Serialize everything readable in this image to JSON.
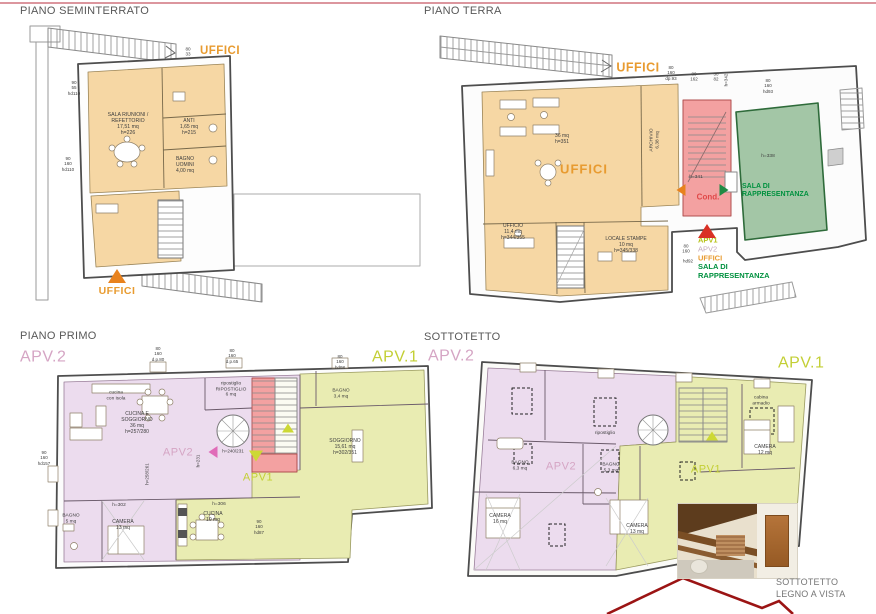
{
  "page": {
    "top_rule_color": "#dc969e"
  },
  "plans": {
    "seminterrato": {
      "title": "PIANO SEMINTERRATO"
    },
    "terra": {
      "title": "PIANO TERRA"
    },
    "primo": {
      "title": "PIANO PRIMO"
    },
    "sottotetto": {
      "title": "SOTTOTETTO"
    }
  },
  "photo": {
    "caption": "SOTTOTETTO\nLEGNO A VISTA"
  },
  "colors": {
    "uffici_orange": "#e89b30",
    "apv1_green": "#c3cf35",
    "apv2_pink": "#d5a5c4",
    "sala_green": "#00913f",
    "cond_red": "#e04848",
    "fill_orange": "#f6d7a4",
    "fill_pink": "#ecdcee",
    "fill_yellow": "#e9ecb2",
    "fill_green": "#a3c6a6",
    "fill_stair_red": "#f3a1a1"
  },
  "labels": [
    {
      "name": "label-uffici-top-seminterrato",
      "text": "UFFICI",
      "x": 220,
      "y": 52,
      "size": 11.5,
      "color": "#e89b30",
      "bold": 1,
      "ls": 0.5
    },
    {
      "name": "label-sala-riunioni",
      "text": "SALA RIUNIONI /\nREFETTORIO\n17,51 mq\nh=226",
      "x": 128,
      "y": 124,
      "size": 5.2
    },
    {
      "name": "label-anti",
      "text": "ANTI\n1,65 mq\nh=215",
      "x": 189,
      "y": 128,
      "size": 5
    },
    {
      "name": "label-bagno-uomini",
      "text": "BAGNO\nUOMINI\n4,00 mq",
      "x": 185,
      "y": 166,
      "size": 5
    },
    {
      "name": "label-uffici-entrance-seminterrato",
      "text": "UFFICI",
      "x": 117,
      "y": 291,
      "size": 10.5,
      "color": "#e89b30",
      "bold": 1,
      "ls": 0.5
    },
    {
      "name": "dim-sem-1",
      "text": "90\n55\nhd110",
      "x": 74,
      "y": 88,
      "size": 4.6
    },
    {
      "name": "dim-sem-2",
      "text": "90\n160\nhd110",
      "x": 68,
      "y": 164,
      "size": 4.6
    },
    {
      "name": "dim-sem-3",
      "text": "80\n33",
      "x": 188,
      "y": 52,
      "size": 4.6
    },
    {
      "name": "label-uffici-top-terra",
      "text": "UFFICI",
      "x": 638,
      "y": 68,
      "size": 12.5,
      "color": "#e89b30",
      "bold": 1,
      "ls": 0.5
    },
    {
      "name": "label-open-space",
      "text": "36 mq\nh=351",
      "x": 562,
      "y": 140,
      "size": 5
    },
    {
      "name": "label-uffici-main",
      "text": "UFFICI",
      "x": 584,
      "y": 169,
      "size": 13,
      "color": "#e89b30",
      "bold": 1,
      "ls": 1
    },
    {
      "name": "label-archivio",
      "text": "ARCHIVIO\n6,38 mq",
      "x": 655,
      "y": 140,
      "size": 4.8,
      "rot": -90
    },
    {
      "name": "label-ufficio",
      "text": "UFFICIO\n11,4 mq\nh=344/355",
      "x": 513,
      "y": 233,
      "size": 5
    },
    {
      "name": "label-locale-stampe",
      "text": "LOCALE STAMPE\n10 mq\nh=345/338",
      "x": 626,
      "y": 246,
      "size": 5
    },
    {
      "name": "label-h341",
      "text": "h=341",
      "x": 696,
      "y": 178,
      "size": 4.8
    },
    {
      "name": "label-cond",
      "text": "Cond.",
      "x": 708,
      "y": 197,
      "size": 8,
      "color": "#e04848",
      "bold": 1
    },
    {
      "name": "label-h338",
      "text": "h=338",
      "x": 768,
      "y": 157,
      "size": 4.8
    },
    {
      "name": "label-sala-rappresentanza-plan",
      "text": "SALA DI\nRAPPRESENTANZA",
      "x": 742,
      "y": 191,
      "size": 7,
      "color": "#00913f",
      "bold": 1,
      "align": "l"
    },
    {
      "name": "legend-apv1",
      "text": "APV1",
      "x": 698,
      "y": 241,
      "size": 7.5,
      "color": "#b5c117",
      "bold": 1,
      "align": "l"
    },
    {
      "name": "legend-apv2",
      "text": "APV2",
      "x": 698,
      "y": 250,
      "size": 7.5,
      "color": "#c2a9bd",
      "align": "l"
    },
    {
      "name": "legend-uffici",
      "text": "UFFICI",
      "x": 698,
      "y": 259,
      "size": 7.5,
      "color": "#e89b30",
      "bold": 1,
      "align": "l"
    },
    {
      "name": "legend-sala-rappresentanza",
      "text": "SALA DI\nRAPPRESENTANZA",
      "x": 698,
      "y": 272,
      "size": 7.5,
      "color": "#00913f",
      "bold": 1,
      "align": "l"
    },
    {
      "name": "dim-terra-1",
      "text": "80\n160\ndp.93",
      "x": 671,
      "y": 73,
      "size": 4.5
    },
    {
      "name": "dim-terra-2",
      "text": "80\n162",
      "x": 694,
      "y": 77,
      "size": 4.5
    },
    {
      "name": "dim-terra-3",
      "text": "30\n82",
      "x": 716,
      "y": 77,
      "size": 4.5
    },
    {
      "name": "dim-terra-4",
      "text": "h=342",
      "x": 726,
      "y": 80,
      "size": 4.5,
      "rot": -90
    },
    {
      "name": "dim-terra-5",
      "text": "80\n160\nhd93",
      "x": 768,
      "y": 86,
      "size": 4.5
    },
    {
      "name": "dim-terra-6",
      "text": "80\n160",
      "x": 686,
      "y": 249,
      "size": 4.5
    },
    {
      "name": "dim-terra-7",
      "text": "hd92",
      "x": 688,
      "y": 261,
      "size": 4.5
    },
    {
      "name": "label-apv2-primo",
      "text": "APV.2",
      "x": 20,
      "y": 358,
      "size": 16,
      "color": "#d5a5c4",
      "align": "l",
      "ls": 0.5
    },
    {
      "name": "label-apv1-primo",
      "text": "APV.1",
      "x": 372,
      "y": 358,
      "size": 16,
      "color": "#c3cf35",
      "align": "l",
      "ls": 0.5
    },
    {
      "name": "label-cucina-isola",
      "text": "cucina\ncon isola",
      "x": 116,
      "y": 396,
      "size": 4.8
    },
    {
      "name": "label-cucina-soggiorno",
      "text": "CUCINA E\nSOGGIORNO\n36 mq\nh=257/280",
      "x": 137,
      "y": 424,
      "size": 5
    },
    {
      "name": "label-ripostiglio-primo",
      "text": "ripostiglio\nRIPOSTIGLIO\n6 mq",
      "x": 231,
      "y": 390,
      "size": 4.8
    },
    {
      "name": "label-apv2-watermark-primo",
      "text": "APV2",
      "x": 178,
      "y": 453,
      "size": 11,
      "color": "#d5a5c4",
      "ls": 0.5
    },
    {
      "name": "label-h240",
      "text": "h=240/231",
      "x": 233,
      "y": 451,
      "size": 4.5
    },
    {
      "name": "label-h231",
      "text": "h=231",
      "x": 198,
      "y": 461,
      "size": 4.5,
      "rot": -90
    },
    {
      "name": "label-h258",
      "text": "h=258/261",
      "x": 147,
      "y": 474,
      "size": 4.5,
      "rot": -90
    },
    {
      "name": "label-apv1-watermark-primo",
      "text": "APV1",
      "x": 258,
      "y": 478,
      "size": 11,
      "color": "#c3cf35",
      "ls": 0.5
    },
    {
      "name": "label-bagno34",
      "text": "BAGNO\n3,4 mq",
      "x": 341,
      "y": 394,
      "size": 4.8
    },
    {
      "name": "label-soggiorno",
      "text": "SOGGIORNO\n15,61 mq\nh=302/351",
      "x": 345,
      "y": 448,
      "size": 5
    },
    {
      "name": "label-h302",
      "text": "h=302",
      "x": 119,
      "y": 506,
      "size": 4.8
    },
    {
      "name": "label-camera13-primo",
      "text": "CAMERA\n13 mq",
      "x": 123,
      "y": 526,
      "size": 5
    },
    {
      "name": "label-bagno5",
      "text": "BAGNO\n5 mq",
      "x": 71,
      "y": 519,
      "size": 4.8
    },
    {
      "name": "label-cucina10",
      "text": "CUCINA\n10 mq",
      "x": 213,
      "y": 518,
      "size": 5
    },
    {
      "name": "label-h306",
      "text": "h=306",
      "x": 219,
      "y": 505,
      "size": 4.8
    },
    {
      "name": "dim-primo-1",
      "text": "80\n160\nd.p.80",
      "x": 158,
      "y": 354,
      "size": 4.5
    },
    {
      "name": "dim-primo-2",
      "text": "80\n160\nd.p.65",
      "x": 232,
      "y": 356,
      "size": 4.5
    },
    {
      "name": "dim-primo-3",
      "text": "80\n160\nhd98",
      "x": 340,
      "y": 362,
      "size": 4.5
    },
    {
      "name": "dim-primo-4",
      "text": "90\n160\nhd157",
      "x": 44,
      "y": 458,
      "size": 4.5
    },
    {
      "name": "dim-primo-5",
      "text": "90\n160\nhd87",
      "x": 259,
      "y": 527,
      "size": 4.5
    },
    {
      "name": "label-apv2-sottotetto",
      "text": "APV.2",
      "x": 428,
      "y": 357,
      "size": 16,
      "color": "#d5a5c4",
      "align": "l",
      "ls": 0.5
    },
    {
      "name": "label-apv1-sottotetto",
      "text": "APV.1",
      "x": 778,
      "y": 364,
      "size": 16,
      "color": "#c3cf35",
      "align": "l",
      "ls": 0.5
    },
    {
      "name": "label-camera16",
      "text": "CAMERA\n16 mq",
      "x": 500,
      "y": 520,
      "size": 5
    },
    {
      "name": "label-bagno63",
      "text": "BAGNO\n6,3 mq",
      "x": 520,
      "y": 466,
      "size": 4.8
    },
    {
      "name": "label-apv2-watermark-sotto",
      "text": "APV2",
      "x": 561,
      "y": 467,
      "size": 11,
      "color": "#d5a5c4",
      "ls": 0.5
    },
    {
      "name": "label-bagno53",
      "text": "BAGNO\n5,3 mq",
      "x": 611,
      "y": 468,
      "size": 4.8
    },
    {
      "name": "label-ripostiglio-sotto",
      "text": "ripostiglio",
      "x": 605,
      "y": 434,
      "size": 4.8
    },
    {
      "name": "label-camera13-sotto",
      "text": "CAMERA\n13 mq",
      "x": 637,
      "y": 530,
      "size": 5
    },
    {
      "name": "label-camera12",
      "text": "CAMERA\n12 mq",
      "x": 765,
      "y": 451,
      "size": 5
    },
    {
      "name": "label-cabina-armadio",
      "text": "cabina\narmadio",
      "x": 761,
      "y": 401,
      "size": 4.8
    },
    {
      "name": "label-apv1-watermark-sotto",
      "text": "APV1",
      "x": 706,
      "y": 470,
      "size": 11,
      "color": "#c3cf35",
      "ls": 0.5
    }
  ],
  "arrows": [
    {
      "name": "arrow-entrance-seminterrato",
      "x": 117,
      "y": 276,
      "dir": "up",
      "color": "#e8821e",
      "size": 9
    },
    {
      "name": "arrow-entrance-terra",
      "x": 707,
      "y": 231,
      "dir": "up",
      "color": "#d93025",
      "size": 9
    },
    {
      "name": "arrow-cond-left",
      "x": 681,
      "y": 190,
      "dir": "left",
      "color": "#e8821e",
      "size": 6
    },
    {
      "name": "arrow-sala-right",
      "x": 724,
      "y": 190,
      "dir": "right",
      "color": "#1f8a44",
      "size": 6
    },
    {
      "name": "arrow-apv2-primo",
      "x": 213,
      "y": 452,
      "dir": "left",
      "color": "#e06cb8",
      "size": 6
    },
    {
      "name": "arrow-apv1-primo",
      "x": 256,
      "y": 456,
      "dir": "down",
      "color": "#cdd835",
      "size": 7
    },
    {
      "name": "arrow-stair-primo",
      "x": 288,
      "y": 428,
      "dir": "up",
      "color": "#cdd835",
      "size": 6
    },
    {
      "name": "arrow-stair-sotto",
      "x": 712,
      "y": 436,
      "dir": "up",
      "color": "#cdd835",
      "size": 6
    }
  ]
}
